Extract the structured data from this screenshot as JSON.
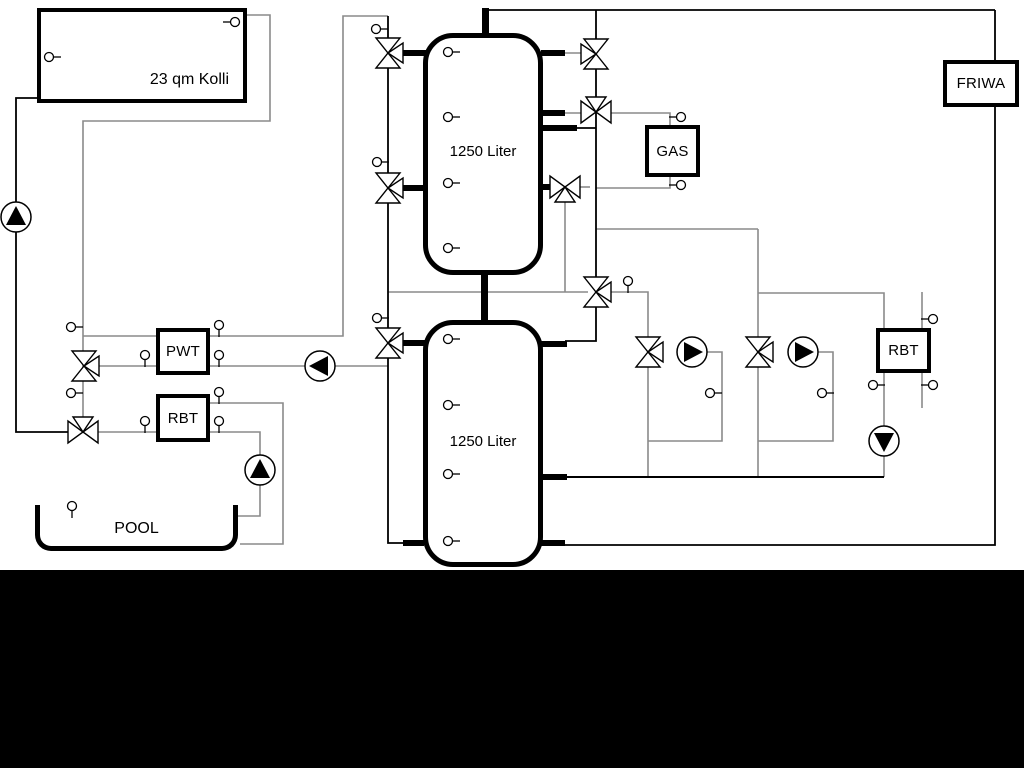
{
  "diagram": {
    "type": "hydraulic-heating-schematic",
    "labels": {
      "collector": "23 qm Kolli",
      "tank_top": "1250 Liter",
      "tank_bottom": "1250 Liter",
      "pwt": "PWT",
      "rbt_left": "RBT",
      "rbt_right": "RBT",
      "gas": "GAS",
      "friwa": "FRIWA",
      "pool": "POOL"
    },
    "colors": {
      "background": "#ffffff",
      "pipe_dark": "#000000",
      "pipe_gray": "#8a8a8a",
      "bottom_band": "#000000"
    }
  }
}
